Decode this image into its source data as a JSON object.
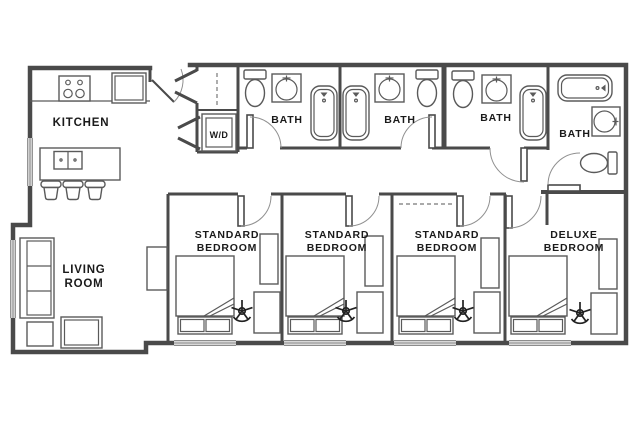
{
  "image": {
    "type": "apartment floor plan"
  },
  "colors": {
    "background": "#ffffff",
    "wall": "#4a4a4a",
    "fixture": "#5a5a5a",
    "text": "#1a1a1a",
    "arc": "#909090"
  },
  "rooms": {
    "kitchen": {
      "label": "KITCHEN"
    },
    "living_room": {
      "line1": "LIVING",
      "line2": "ROOM"
    },
    "laundry": {
      "label": "W/D"
    },
    "baths": [
      {
        "label": "BATH"
      },
      {
        "label": "BATH"
      },
      {
        "label": "BATH"
      },
      {
        "label": "BATH"
      }
    ],
    "bedrooms": [
      {
        "line1": "STANDARD",
        "line2": "BEDROOM"
      },
      {
        "line1": "STANDARD",
        "line2": "BEDROOM"
      },
      {
        "line1": "STANDARD",
        "line2": "BEDROOM"
      },
      {
        "line1": "DELUXE",
        "line2": "BEDROOM"
      }
    ]
  }
}
